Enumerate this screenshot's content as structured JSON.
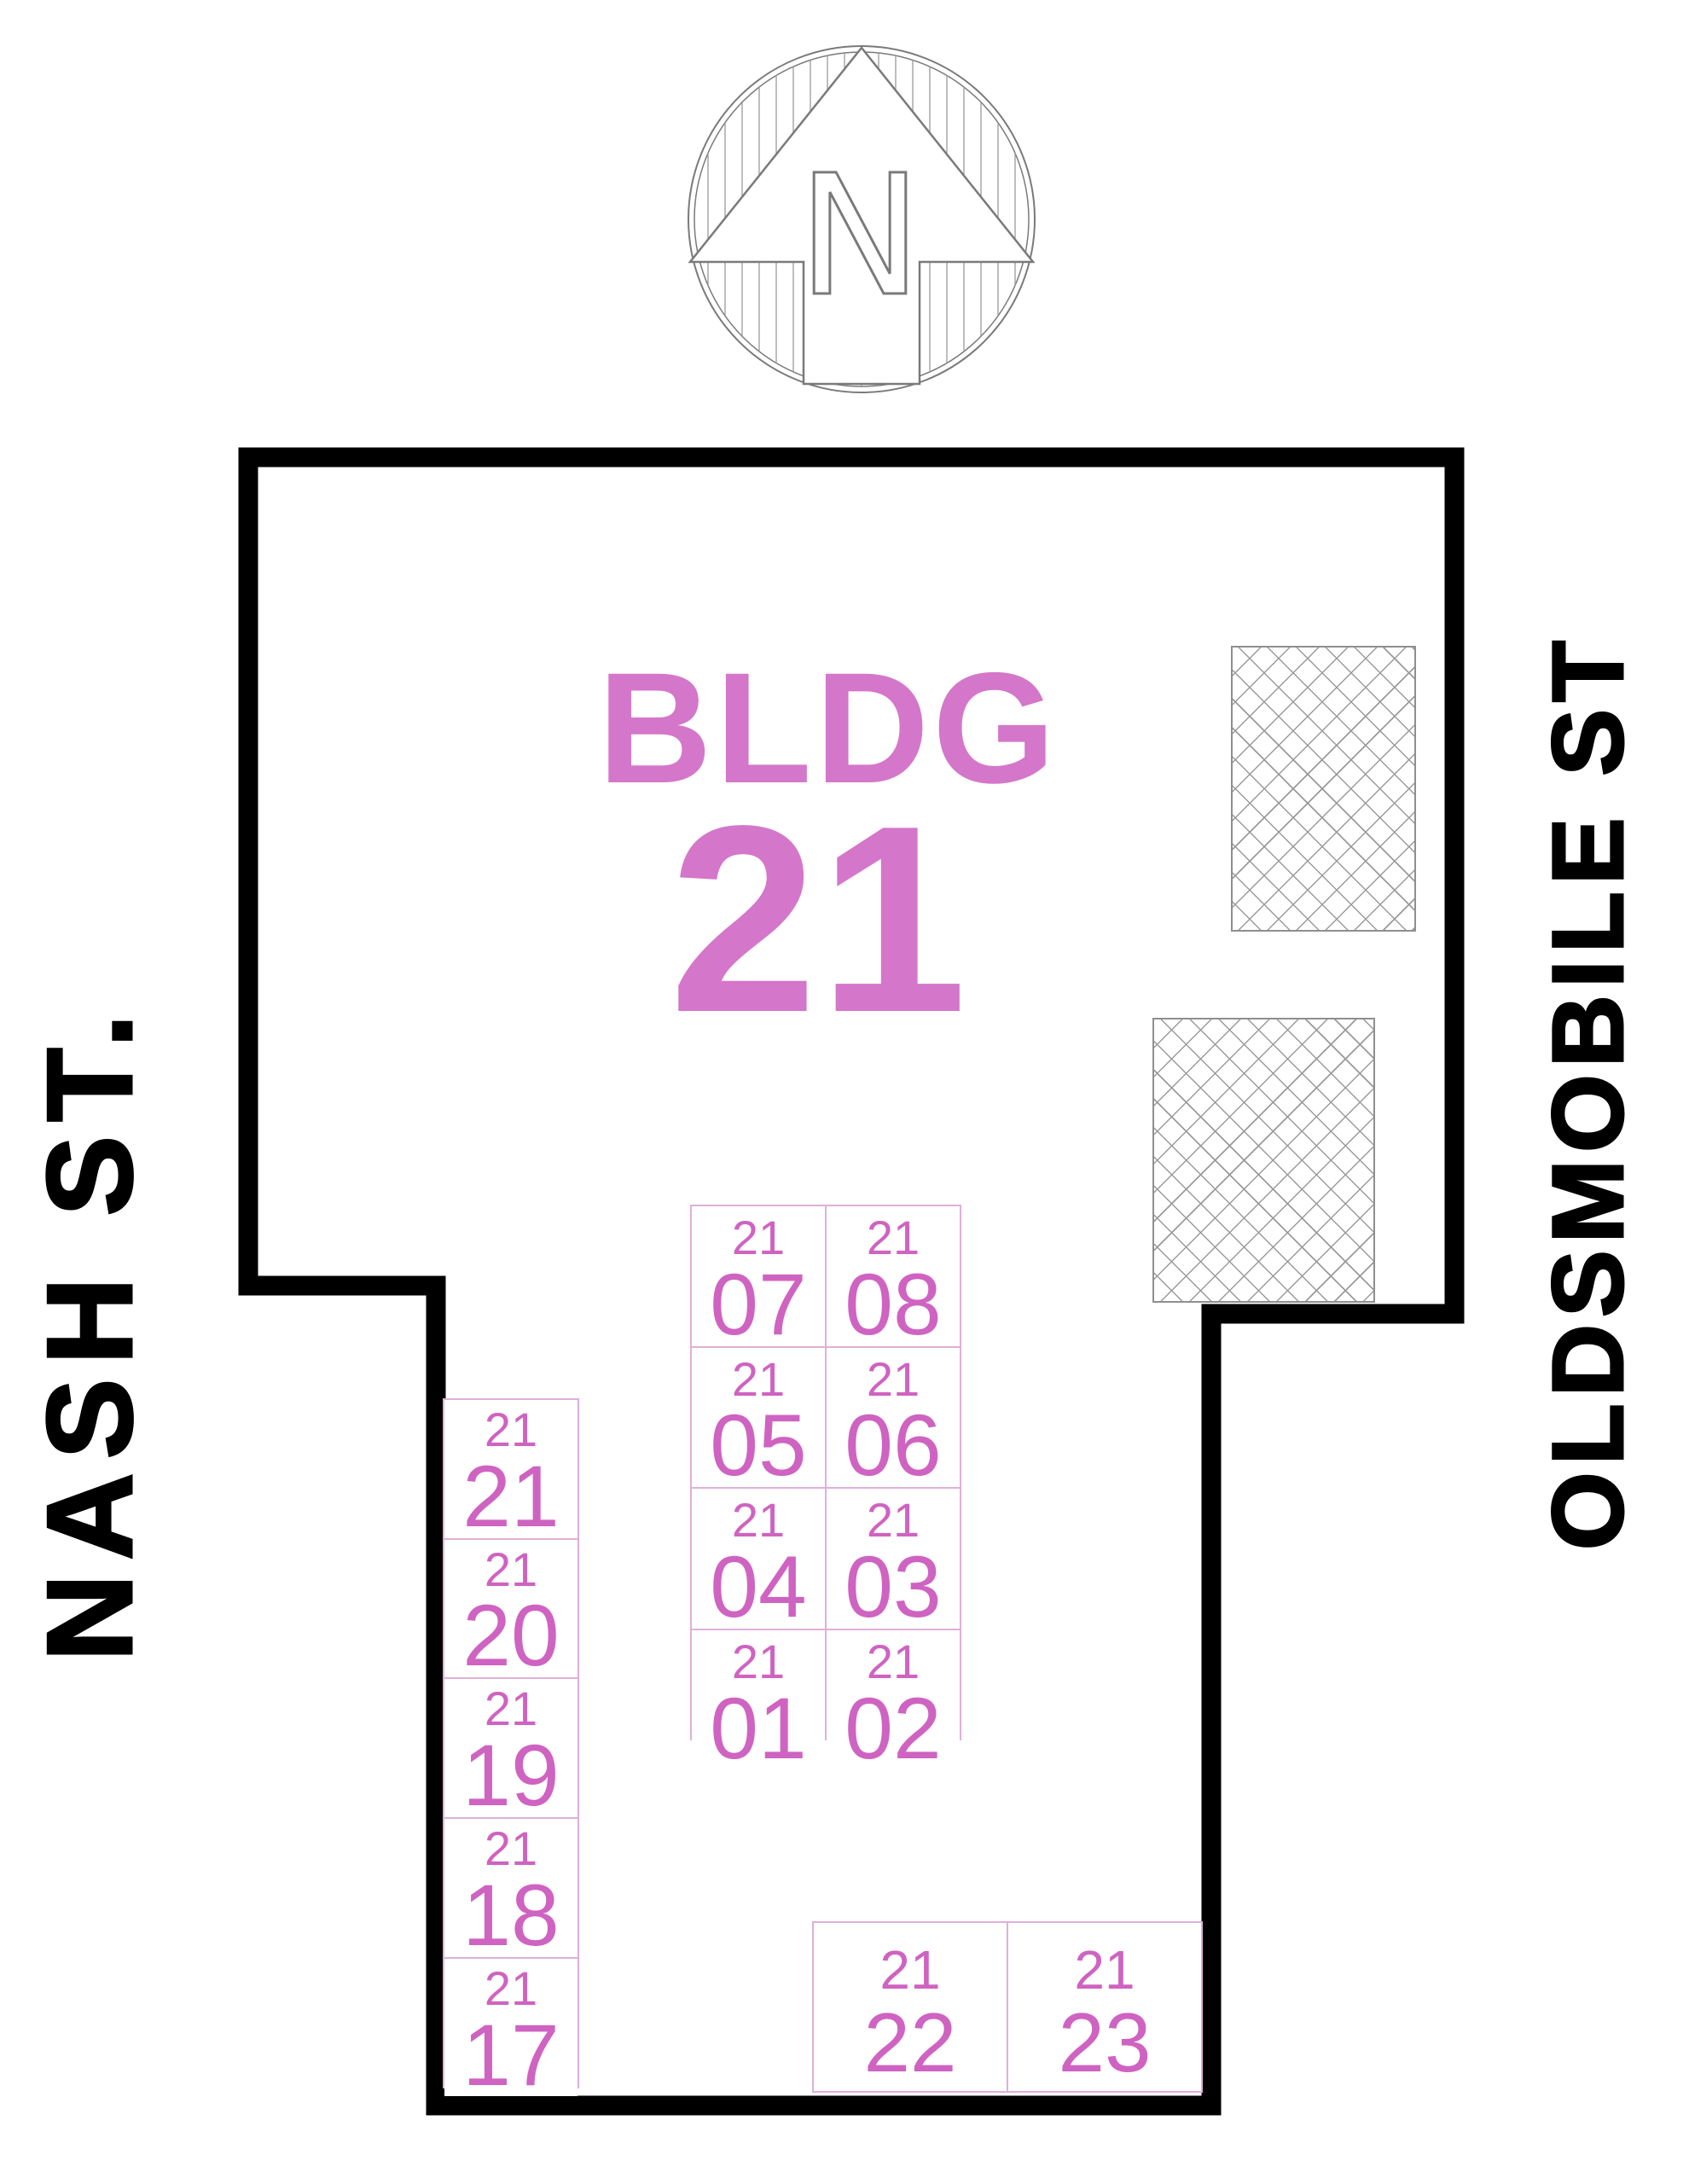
{
  "north": {
    "label": "N"
  },
  "streets": {
    "left": "NASH ST.",
    "right": "OLDSMOBILE ST"
  },
  "building": {
    "label": "BLDG",
    "number": "21"
  },
  "units": {
    "center": [
      {
        "bldg": "21",
        "unit": "07"
      },
      {
        "bldg": "21",
        "unit": "08"
      },
      {
        "bldg": "21",
        "unit": "05"
      },
      {
        "bldg": "21",
        "unit": "06"
      },
      {
        "bldg": "21",
        "unit": "04"
      },
      {
        "bldg": "21",
        "unit": "03"
      },
      {
        "bldg": "21",
        "unit": "01"
      },
      {
        "bldg": "21",
        "unit": "02"
      }
    ],
    "left": [
      {
        "bldg": "21",
        "unit": "21"
      },
      {
        "bldg": "21",
        "unit": "20"
      },
      {
        "bldg": "21",
        "unit": "19"
      },
      {
        "bldg": "21",
        "unit": "18"
      },
      {
        "bldg": "21",
        "unit": "17"
      }
    ],
    "bottom": [
      {
        "bldg": "21",
        "unit": "22"
      },
      {
        "bldg": "21",
        "unit": "23"
      }
    ]
  },
  "colors": {
    "wall": "#000000",
    "pink_heading": "#d476ca",
    "pink_unit": "#cf63c1",
    "cell_border": "#dfafda",
    "outline_gray": "#7a7a7a",
    "hatch_gray": "#9a9a9a"
  }
}
